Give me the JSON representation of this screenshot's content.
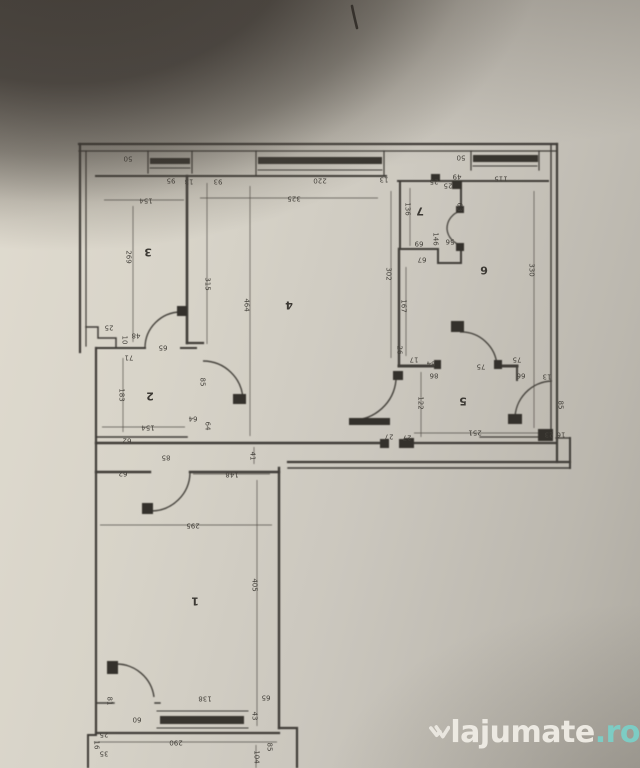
{
  "watermark": {
    "brand": "lajumate",
    "tld": ".ro",
    "brand_color": "#f0ede6",
    "tld_color": "#7ccfc7"
  },
  "floorplan": {
    "orientation": "rotated-180",
    "room_labels": [
      {
        "n": "1",
        "x": 195,
        "y": 601
      },
      {
        "n": "2",
        "x": 150,
        "y": 396
      },
      {
        "n": "3",
        "x": 148,
        "y": 252
      },
      {
        "n": "4",
        "x": 289,
        "y": 305
      },
      {
        "n": "5",
        "x": 463,
        "y": 401
      },
      {
        "n": "6",
        "x": 484,
        "y": 270
      },
      {
        "n": "7",
        "x": 420,
        "y": 211
      }
    ],
    "dimension_labels": [
      {
        "v": "50",
        "x": 128,
        "y": 158,
        "r": 180
      },
      {
        "v": "95",
        "x": 171,
        "y": 180,
        "r": 180
      },
      {
        "v": "13",
        "x": 189,
        "y": 181,
        "r": 180
      },
      {
        "v": "154",
        "x": 146,
        "y": 200,
        "r": 180
      },
      {
        "v": "93",
        "x": 218,
        "y": 181,
        "r": 180
      },
      {
        "v": "220",
        "x": 320,
        "y": 180,
        "r": 180
      },
      {
        "v": "325",
        "x": 294,
        "y": 198,
        "r": 180
      },
      {
        "v": "13",
        "x": 384,
        "y": 179,
        "r": 180
      },
      {
        "v": "25",
        "x": 434,
        "y": 181,
        "r": 180
      },
      {
        "v": "49",
        "x": 457,
        "y": 176,
        "r": 180
      },
      {
        "v": "25",
        "x": 448,
        "y": 185,
        "r": 180
      },
      {
        "v": "50",
        "x": 461,
        "y": 157,
        "r": 180
      },
      {
        "v": "115",
        "x": 501,
        "y": 178,
        "r": 180
      },
      {
        "v": "269",
        "x": 128,
        "y": 257,
        "r": 90
      },
      {
        "v": "315",
        "x": 207,
        "y": 284,
        "r": 90
      },
      {
        "v": "464",
        "x": 246,
        "y": 305,
        "r": 90
      },
      {
        "v": "136",
        "x": 407,
        "y": 209,
        "r": 90
      },
      {
        "v": "63",
        "x": 459,
        "y": 207,
        "r": 90
      },
      {
        "v": "69",
        "x": 419,
        "y": 243,
        "r": 180
      },
      {
        "v": "146",
        "x": 435,
        "y": 239,
        "r": 90
      },
      {
        "v": "56",
        "x": 450,
        "y": 241,
        "r": 180
      },
      {
        "v": "67",
        "x": 422,
        "y": 259,
        "r": 180
      },
      {
        "v": "302",
        "x": 388,
        "y": 274,
        "r": 90
      },
      {
        "v": "167",
        "x": 403,
        "y": 306,
        "r": 90
      },
      {
        "v": "330",
        "x": 531,
        "y": 270,
        "r": 90
      },
      {
        "v": "25",
        "x": 109,
        "y": 327,
        "r": 180
      },
      {
        "v": "48",
        "x": 136,
        "y": 335,
        "r": 180
      },
      {
        "v": "10",
        "x": 124,
        "y": 340,
        "r": 90
      },
      {
        "v": "71",
        "x": 129,
        "y": 357,
        "r": 180
      },
      {
        "v": "65",
        "x": 163,
        "y": 347,
        "r": 180
      },
      {
        "v": "85",
        "x": 202,
        "y": 382,
        "r": 90
      },
      {
        "v": "183",
        "x": 121,
        "y": 395,
        "r": 90
      },
      {
        "v": "64",
        "x": 193,
        "y": 418,
        "r": 180
      },
      {
        "v": "64",
        "x": 207,
        "y": 426,
        "r": 90
      },
      {
        "v": "154",
        "x": 148,
        "y": 427,
        "r": 180
      },
      {
        "v": "62",
        "x": 127,
        "y": 440,
        "r": 180
      },
      {
        "v": "26",
        "x": 399,
        "y": 350,
        "r": 90
      },
      {
        "v": "17",
        "x": 414,
        "y": 359,
        "r": 180
      },
      {
        "v": "84",
        "x": 431,
        "y": 363,
        "r": 180
      },
      {
        "v": "86",
        "x": 434,
        "y": 375,
        "r": 180
      },
      {
        "v": "75",
        "x": 481,
        "y": 366,
        "r": 180
      },
      {
        "v": "75",
        "x": 517,
        "y": 359,
        "r": 180
      },
      {
        "v": "66",
        "x": 521,
        "y": 375,
        "r": 180
      },
      {
        "v": "13",
        "x": 547,
        "y": 376,
        "r": 180
      },
      {
        "v": "122",
        "x": 420,
        "y": 403,
        "r": 90
      },
      {
        "v": "85",
        "x": 560,
        "y": 405,
        "r": 90
      },
      {
        "v": "251",
        "x": 475,
        "y": 432,
        "r": 180
      },
      {
        "v": "27",
        "x": 389,
        "y": 436,
        "r": 180
      },
      {
        "v": "27",
        "x": 407,
        "y": 437,
        "r": 180
      },
      {
        "v": "23",
        "x": 549,
        "y": 434,
        "r": 180
      },
      {
        "v": "16",
        "x": 561,
        "y": 434,
        "r": 180
      },
      {
        "v": "41",
        "x": 252,
        "y": 456,
        "r": 90
      },
      {
        "v": "85",
        "x": 166,
        "y": 457,
        "r": 180
      },
      {
        "v": "148",
        "x": 232,
        "y": 474,
        "r": 180
      },
      {
        "v": "62",
        "x": 123,
        "y": 473,
        "r": 180
      },
      {
        "v": "295",
        "x": 193,
        "y": 525,
        "r": 180
      },
      {
        "v": "405",
        "x": 254,
        "y": 585,
        "r": 90
      },
      {
        "v": "81",
        "x": 109,
        "y": 701,
        "r": 90
      },
      {
        "v": "60",
        "x": 137,
        "y": 719,
        "r": 180
      },
      {
        "v": "138",
        "x": 205,
        "y": 698,
        "r": 180
      },
      {
        "v": "65",
        "x": 266,
        "y": 697,
        "r": 180
      },
      {
        "v": "43",
        "x": 254,
        "y": 716,
        "r": 90
      },
      {
        "v": "25",
        "x": 104,
        "y": 734,
        "r": 180
      },
      {
        "v": "16",
        "x": 96,
        "y": 745,
        "r": 90
      },
      {
        "v": "35",
        "x": 104,
        "y": 753,
        "r": 180
      },
      {
        "v": "290",
        "x": 176,
        "y": 742,
        "r": 180
      },
      {
        "v": "104",
        "x": 256,
        "y": 757,
        "r": 90
      },
      {
        "v": "85",
        "x": 269,
        "y": 747,
        "r": 90
      }
    ]
  }
}
